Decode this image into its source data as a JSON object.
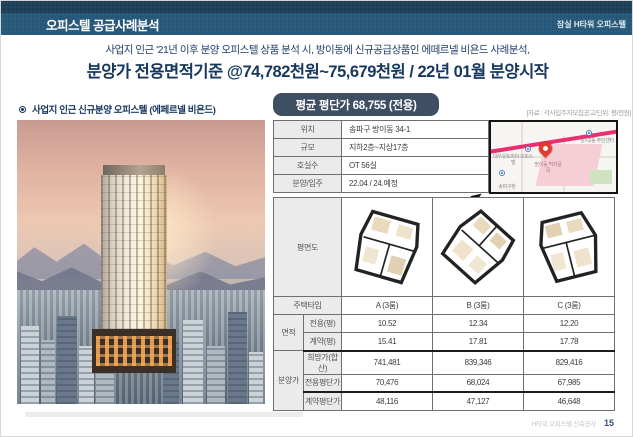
{
  "header": {
    "title": "오피스텔 공급사례분석",
    "project": "잠실 H타워 오피스텔"
  },
  "subtitle": {
    "line1": "사업지 인근  '21년 이후 분양 오피스텔 상품 분석 시, 방이동에 신규공급상품인 에떼르넬 비욘드 사례분석,",
    "line2": "분양가 전용면적기준 @74,782천원~75,679천원 / 22년 01월 분양시작"
  },
  "left": {
    "section_title": "사업지 인근 신규분양 오피스텔 (에페르넬 비욘드)"
  },
  "right": {
    "badge": "평균 평단가 68,755 (전용)",
    "source_note": "[자료 : 각사입주자모집공고/단위: 평/천원]",
    "info": {
      "rows": [
        {
          "label": "위치",
          "value": "송파구 방이동 34-1"
        },
        {
          "label": "규모",
          "value": "지하2층~지상17층"
        },
        {
          "label": "호실수",
          "value": "OT 56실"
        },
        {
          "label": "분양/입주",
          "value": "22.04 / 24.예정"
        }
      ]
    },
    "plan_label": "평면도",
    "table": {
      "type_label": "주택타입",
      "types": [
        "A (3룸)",
        "B (3룸)",
        "C (3룸)"
      ],
      "area_group": "면적",
      "area_rows": [
        {
          "label": "전용(평)",
          "values": [
            "10.52",
            "12.34",
            "12.20"
          ]
        },
        {
          "label": "계약(평)",
          "values": [
            "15.41",
            "17.81",
            "17.78"
          ]
        }
      ],
      "price_group": "분양가",
      "price_rows": [
        {
          "label": "희망가(합산)",
          "values": [
            "741,481",
            "839,346",
            "829,416"
          ]
        },
        {
          "label": "전용평단가",
          "values": [
            "70,476",
            "68,024",
            "67,985"
          ]
        },
        {
          "label": "계약평단가",
          "values": [
            "48,116",
            "47,127",
            "46,648"
          ]
        }
      ]
    }
  },
  "map": {
    "labels": [
      "방이2동 주민센터",
      "대우유토피아 오피스텔",
      "방이동 먹자골목",
      "송파구청"
    ]
  },
  "footer": {
    "text": "H타워 오피스텔 신축공사",
    "page": "15"
  },
  "colors": {
    "top_strip": "#1c3e57",
    "header_band": "#27587a",
    "accent_navy": "#17375e",
    "badge_bg": "#3e4e63",
    "road_pink": "#ec2d6f",
    "pin_red": "#e4392e"
  }
}
